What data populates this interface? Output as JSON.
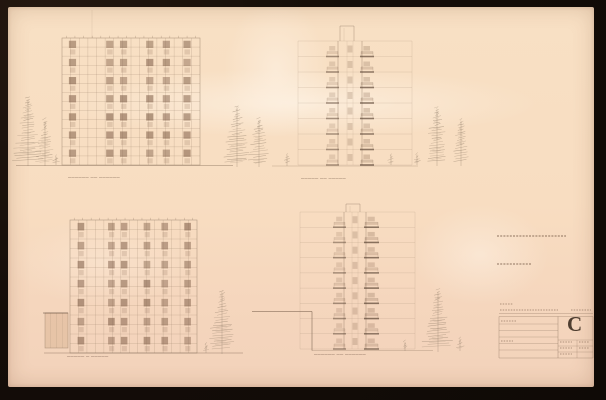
{
  "palette": {
    "background": "#140d08",
    "paper": "#f8ddc1",
    "ink_faint": "#927a63",
    "ink_medium": "#7c6450",
    "ink_dark": "#5a4434",
    "window_fill": "#7b5a44",
    "tree_ink": "#7d6b58",
    "letter_color": "#392a1d"
  },
  "captions": {
    "upper_left": {
      "x": 68,
      "y": 175,
      "text": "────── ── ──────"
    },
    "upper_right": {
      "x": 301,
      "y": 176,
      "text": "───── ── ─────"
    },
    "lower_left": {
      "x": 67,
      "y": 354,
      "text": "───── ─ ─────"
    },
    "lower_right": {
      "x": 314,
      "y": 352,
      "text": "────── ── ──────"
    }
  },
  "grid_buildings": [
    {
      "name": "elevation-upper-left",
      "x": 62,
      "y": 38,
      "w": 138,
      "h": 127,
      "cols": 16,
      "rows": 14,
      "floors": 7,
      "window_cols": [
        0.05,
        0.32,
        0.42,
        0.61,
        0.73,
        0.88
      ]
    },
    {
      "name": "elevation-lower-left",
      "x": 70,
      "y": 220,
      "w": 127,
      "h": 133,
      "cols": 15,
      "rows": 14,
      "floors": 7,
      "window_cols": [
        0.06,
        0.3,
        0.4,
        0.58,
        0.72,
        0.9
      ]
    }
  ],
  "towers": [
    {
      "name": "elevation-upper-right",
      "ex1": 298,
      "ex2": 412,
      "top": 41,
      "ground": 165,
      "floor_count": 8,
      "core_x1": 338,
      "core_x2": 362,
      "bal_l1": 327,
      "bal_l2": 338,
      "bal_r1": 361,
      "bal_r2": 373,
      "shaft_x1": 340,
      "shaft_x2": 354,
      "shaft_top": 26
    },
    {
      "name": "elevation-lower-right",
      "ex1": 300,
      "ex2": 415,
      "top": 212,
      "ground": 349,
      "floor_count": 9,
      "core_x1": 344,
      "core_x2": 366,
      "bal_l1": 334,
      "bal_l2": 345,
      "bal_r1": 365,
      "bal_r2": 378,
      "shaft_x1": 346,
      "shaft_x2": 360,
      "shaft_top": 204
    }
  ],
  "trees": [
    {
      "cx": 28,
      "gy": 166,
      "h": 68,
      "w": 26
    },
    {
      "cx": 45,
      "gy": 166,
      "h": 46,
      "w": 18
    },
    {
      "cx": 56,
      "gy": 165,
      "h": 8,
      "w": 8
    },
    {
      "cx": 237,
      "gy": 167,
      "h": 60,
      "w": 24
    },
    {
      "cx": 259,
      "gy": 167,
      "h": 48,
      "w": 20
    },
    {
      "cx": 287,
      "gy": 166,
      "h": 11,
      "w": 9
    },
    {
      "cx": 391,
      "gy": 165,
      "h": 9,
      "w": 7
    },
    {
      "cx": 417,
      "gy": 165,
      "h": 10,
      "w": 8
    },
    {
      "cx": 437,
      "gy": 166,
      "h": 58,
      "w": 22
    },
    {
      "cx": 461,
      "gy": 166,
      "h": 46,
      "w": 18
    },
    {
      "cx": 206,
      "gy": 353,
      "h": 8,
      "w": 7
    },
    {
      "cx": 222,
      "gy": 354,
      "h": 62,
      "w": 24
    },
    {
      "cx": 405,
      "gy": 351,
      "h": 9,
      "w": 8
    },
    {
      "cx": 438,
      "gy": 352,
      "h": 62,
      "w": 26
    },
    {
      "cx": 460,
      "gy": 351,
      "h": 12,
      "w": 9
    }
  ],
  "ground_lines": [
    {
      "x1": 16,
      "y1": 165.5,
      "x2": 233,
      "y2": 165.5,
      "w": 0.7,
      "op": 0.5
    },
    {
      "x1": 272,
      "y1": 166,
      "x2": 418,
      "y2": 166,
      "w": 0.6,
      "op": 0.45
    },
    {
      "x1": 44,
      "y1": 353,
      "x2": 243,
      "y2": 353,
      "w": 0.7,
      "op": 0.5
    },
    {
      "x1": 312,
      "y1": 350.5,
      "x2": 433,
      "y2": 350.5,
      "w": 0.6,
      "op": 0.5
    },
    {
      "x1": 252,
      "y1": 311.5,
      "x2": 312,
      "y2": 311.5,
      "w": 1,
      "op": 0.55
    },
    {
      "x1": 312,
      "y1": 311.5,
      "x2": 312,
      "y2": 350.5,
      "w": 1,
      "op": 0.55
    }
  ],
  "annex": {
    "x": 45,
    "y": 313,
    "w": 23,
    "h": 35
  },
  "crease": {
    "x": 92,
    "y1": 10,
    "y2": 38
  },
  "annotation_marks": [
    {
      "x": 497,
      "y": 236,
      "len": 69
    },
    {
      "x": 497,
      "y": 264,
      "len": 35
    }
  ],
  "titleblock": {
    "letter": "C",
    "letter_x": 567,
    "letter_y": 313,
    "x1": 499,
    "x2": 593,
    "full_lines_y": [
      313.5,
      316.5,
      358
    ],
    "left_rows_y": [
      324,
      330.5,
      337,
      343.5,
      350
    ],
    "right_rows_y": [
      340,
      346,
      352
    ],
    "divider_x": 558,
    "divider2_x": 577,
    "text_marks": [
      {
        "x": 500,
        "y": 304,
        "len": 13
      },
      {
        "x": 500,
        "y": 310,
        "len": 58
      },
      {
        "x": 571,
        "y": 310,
        "len": 20
      },
      {
        "x": 501,
        "y": 321,
        "len": 16
      },
      {
        "x": 501,
        "y": 341,
        "len": 12
      },
      {
        "x": 560,
        "y": 342,
        "len": 12
      },
      {
        "x": 560,
        "y": 348,
        "len": 12
      },
      {
        "x": 560,
        "y": 354,
        "len": 12
      },
      {
        "x": 579,
        "y": 342,
        "len": 10
      },
      {
        "x": 579,
        "y": 348,
        "len": 10
      }
    ]
  }
}
